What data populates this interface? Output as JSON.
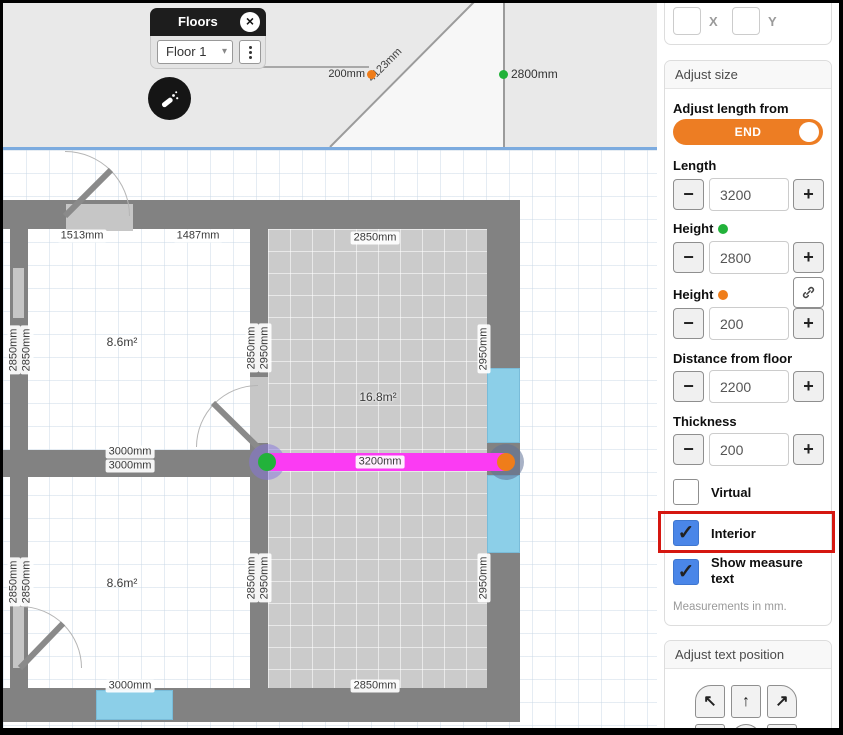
{
  "floors_panel": {
    "title": "Floors",
    "close": "×",
    "selected_floor": "Floor 1",
    "chevron": "▾"
  },
  "elevation": {
    "diagonal": "4123mm",
    "orange_end": "200mm",
    "green_end": "2800mm"
  },
  "coords": {
    "x_label": "X",
    "y_label": "Y"
  },
  "adjust_size": {
    "header": "Adjust size",
    "length_from_label": "Adjust length from",
    "end_toggle": "END",
    "minus": "−",
    "plus": "+",
    "check_glyph": "✓",
    "length": {
      "label": "Length",
      "value": "3200"
    },
    "height_green": {
      "label": "Height",
      "value": "2800"
    },
    "height_orange": {
      "label": "Height",
      "value": "200"
    },
    "distance": {
      "label": "Distance from floor",
      "value": "2200"
    },
    "thickness": {
      "label": "Thickness",
      "value": "200"
    },
    "virtual": {
      "label": "Virtual",
      "checked": false
    },
    "interior": {
      "label": "Interior",
      "checked": true
    },
    "show_measure": {
      "label": "Show measure text",
      "checked": true
    },
    "note": "Measurements in mm."
  },
  "adjust_text": {
    "header": "Adjust text position",
    "arrow_up_left": "↖",
    "arrow_up": "↑",
    "arrow_up_right": "↗"
  },
  "plan": {
    "selected_wall": "3200mm",
    "labels": {
      "top_door_left": "1513mm",
      "top_door_right": "1487mm",
      "room2_top": "2850mm",
      "room2_bottom": "2850mm",
      "room2_side_upper": "2950mm",
      "room2_side_lower": "2950mm",
      "left_upper_a": "2850mm",
      "left_upper_b": "2850mm",
      "left_lower_a": "2850mm",
      "left_lower_b": "2850mm",
      "room1_right_a": "2850mm",
      "room1_right_b": "2950mm",
      "room3_right_a": "2850mm",
      "room3_right_b": "2950mm",
      "mid_a": "3000mm",
      "mid_b": "3000mm",
      "bottom": "3000mm",
      "room1_area": "8.6m²",
      "room2_area": "16.8m²",
      "room3_area": "8.6m²"
    }
  },
  "colors": {
    "selected_wall_magenta": "#fb3bf3",
    "green_endpoint": "#22b23a",
    "orange_endpoint": "#ef7d1a",
    "window_blue": "#8ccfe8",
    "checkbox_blue": "#4a86e8",
    "toggle_orange": "#ed7d23",
    "highlight_red": "#d51710",
    "wall_gray": "#828282"
  }
}
